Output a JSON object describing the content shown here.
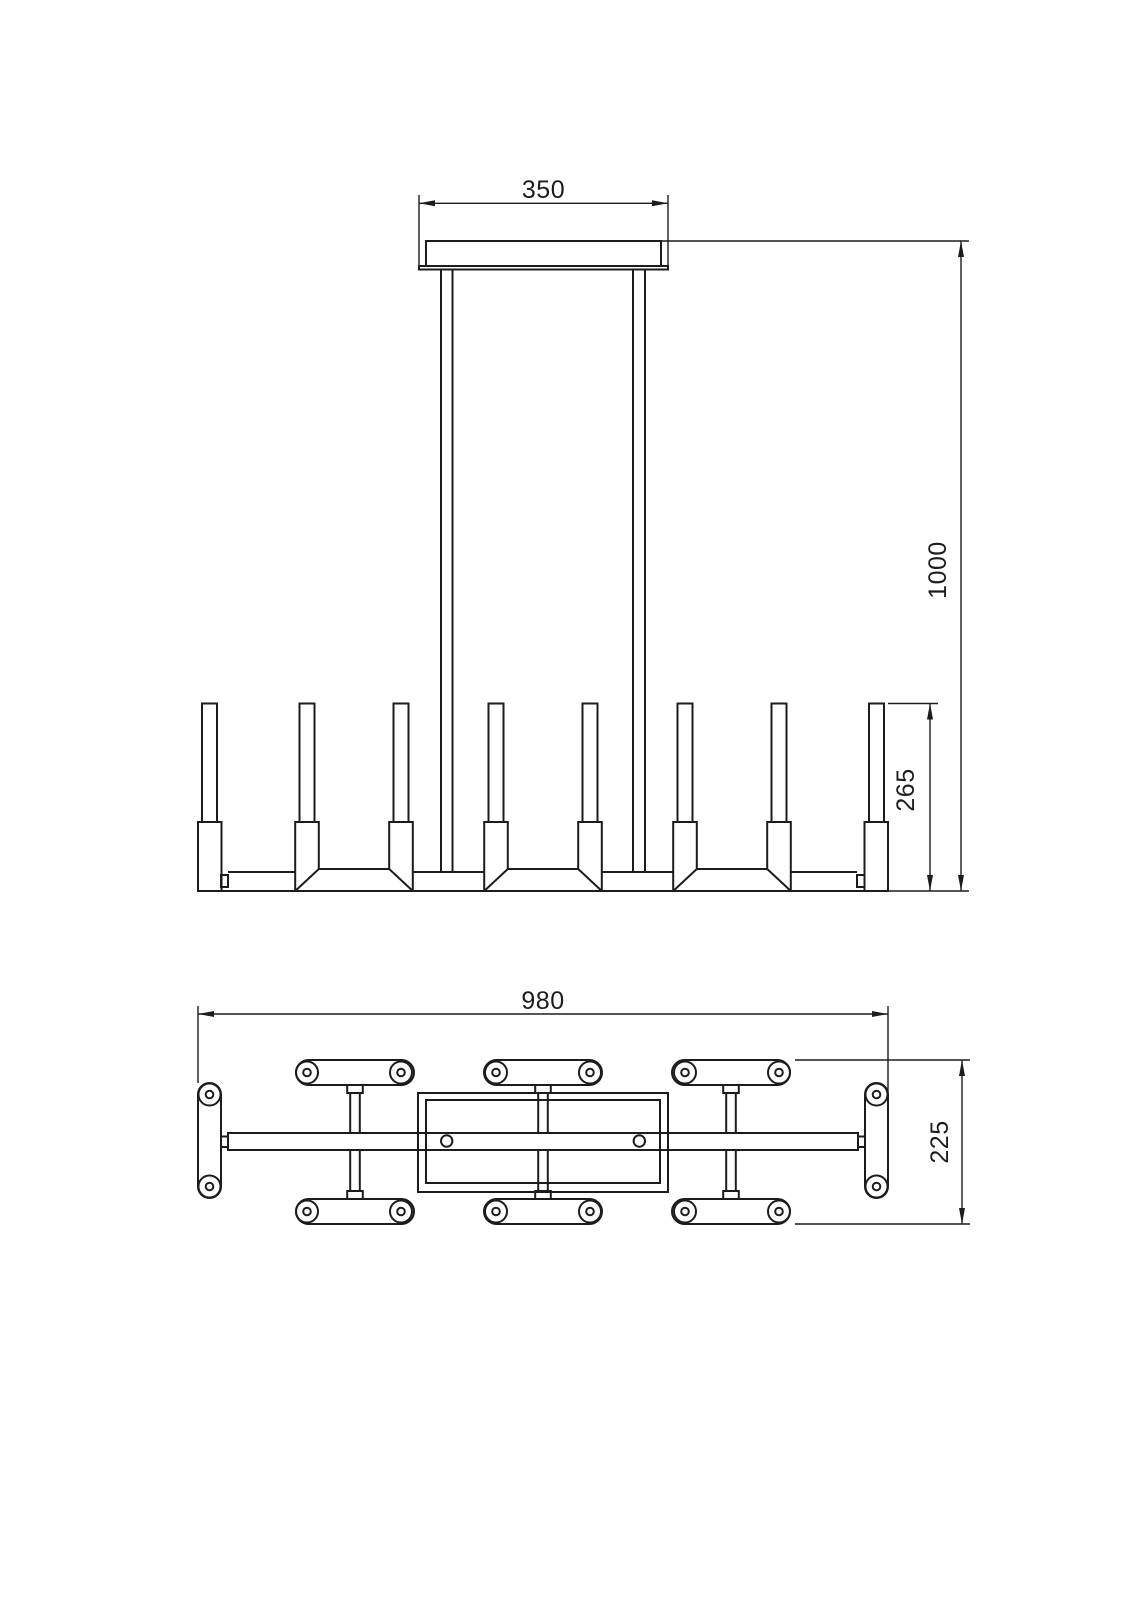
{
  "drawing": {
    "background_color": "#ffffff",
    "line_color": "#1c1c1c",
    "dimensions": {
      "canopy_width": "350",
      "drop_height": "1000",
      "lamp_height": "265",
      "overall_length": "980",
      "overall_depth": "225"
    }
  }
}
